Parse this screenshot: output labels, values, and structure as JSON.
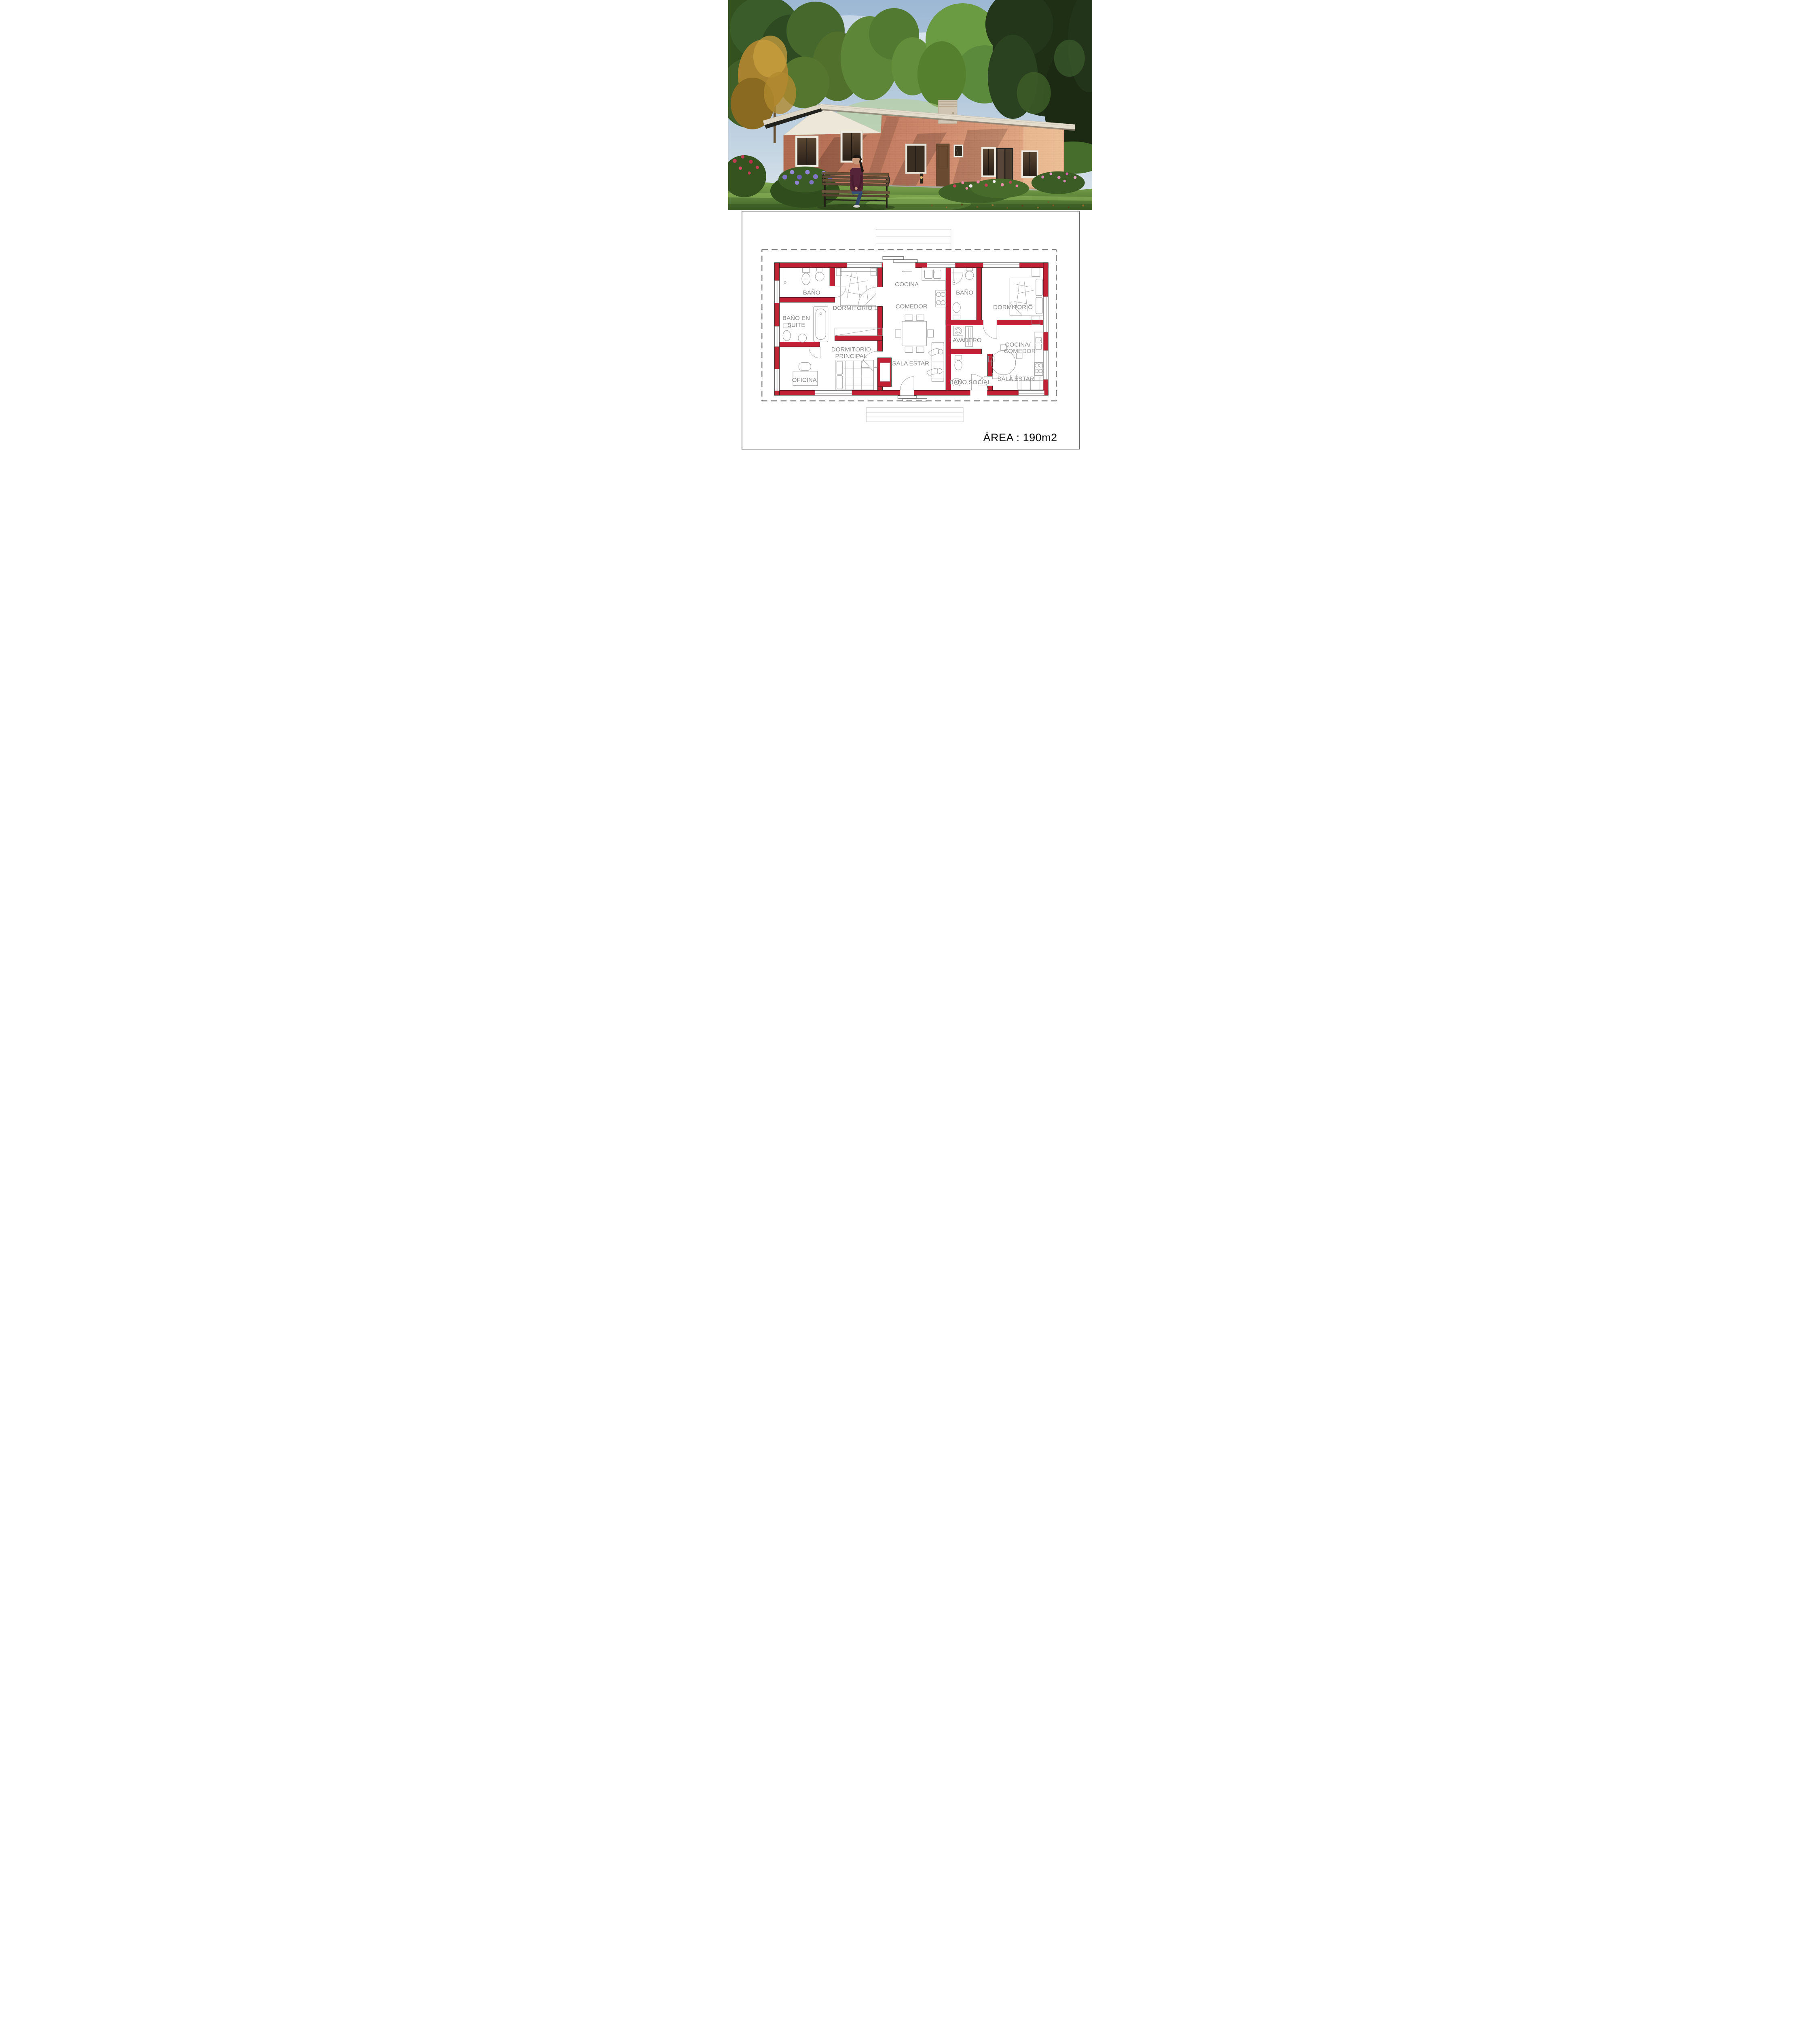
{
  "photo": {
    "description_icons": [
      "house-illustration",
      "bench",
      "woman-figure",
      "trees",
      "flower-beds",
      "lawn",
      "chimney"
    ]
  },
  "plan": {
    "area_label": "ÁREA : 190m2",
    "rooms": [
      {
        "id": "bano-1",
        "label": "BAÑO"
      },
      {
        "id": "dormitorio-1",
        "label": "DORMITORIO 1"
      },
      {
        "id": "bano-en-suite",
        "lines": [
          "BAÑO EN",
          "SUITE"
        ]
      },
      {
        "id": "oficina",
        "label": "OFICINA"
      },
      {
        "id": "dormitorio-principal",
        "lines": [
          "DORMITORIO",
          "PRINCIPAL"
        ]
      },
      {
        "id": "cocina",
        "label": "COCINA"
      },
      {
        "id": "comedor",
        "label": "COMEDOR"
      },
      {
        "id": "sala-estar-1",
        "label": "SALA ESTAR"
      },
      {
        "id": "bano-2",
        "label": "BAÑO"
      },
      {
        "id": "lavadero",
        "label": "LAVADERO"
      },
      {
        "id": "bano-social",
        "label": "BAÑO SOCIAL"
      },
      {
        "id": "dormitorio-2",
        "label": "DORMITORIO"
      },
      {
        "id": "cocina-comedor",
        "lines": [
          "COCINA/",
          "COMEDOR"
        ]
      },
      {
        "id": "sala-estar-2",
        "label": "SALA ESTAR"
      }
    ]
  },
  "colors": {
    "wall_red": "#c22035",
    "label_gray": "#8a8a8a",
    "furniture_gray": "#9b9b9b",
    "brick": "#cf8a6d",
    "fascia": "#ddd5c6",
    "plinth": "#a8a8a0",
    "grass": "#6f9c43",
    "sky": "#9cb8d4"
  }
}
